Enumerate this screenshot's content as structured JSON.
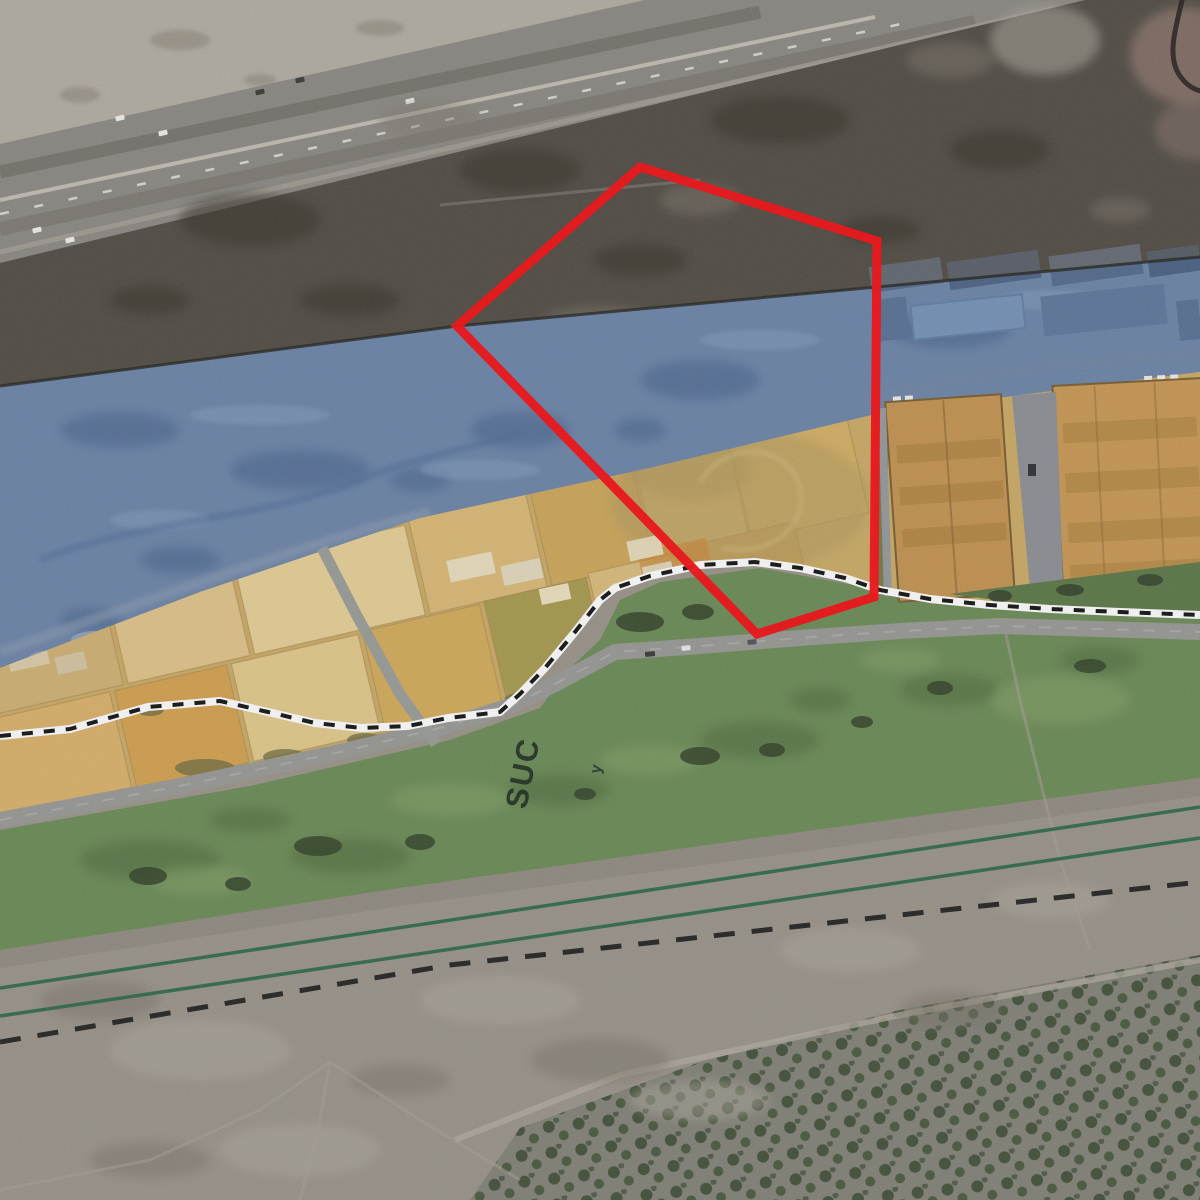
{
  "map": {
    "labels": {
      "zone_label": "SUC",
      "small_marker": "y"
    },
    "colors": {
      "parcel_boundary_red": "#e8191d",
      "blue_zone_overlay": "#3f6ab0",
      "yellow_zone_overlay": "#eaba55",
      "green_zone": "#6d8d58",
      "footpath_white": "#ffffff",
      "footpath_dash": "#151515",
      "channel_line_green": "#2e6b4c",
      "boundary_dash_black": "#1c1c1c"
    },
    "zones": [
      {
        "name": "blue-overlay-zone",
        "color_ref": "blue_zone_overlay"
      },
      {
        "name": "yellow-overlay-zone",
        "color_ref": "yellow_zone_overlay"
      },
      {
        "name": "green-suc-zone",
        "color_ref": "green_zone",
        "label": "SUC"
      },
      {
        "name": "red-parcel-boundary",
        "color_ref": "parcel_boundary_red"
      }
    ]
  }
}
